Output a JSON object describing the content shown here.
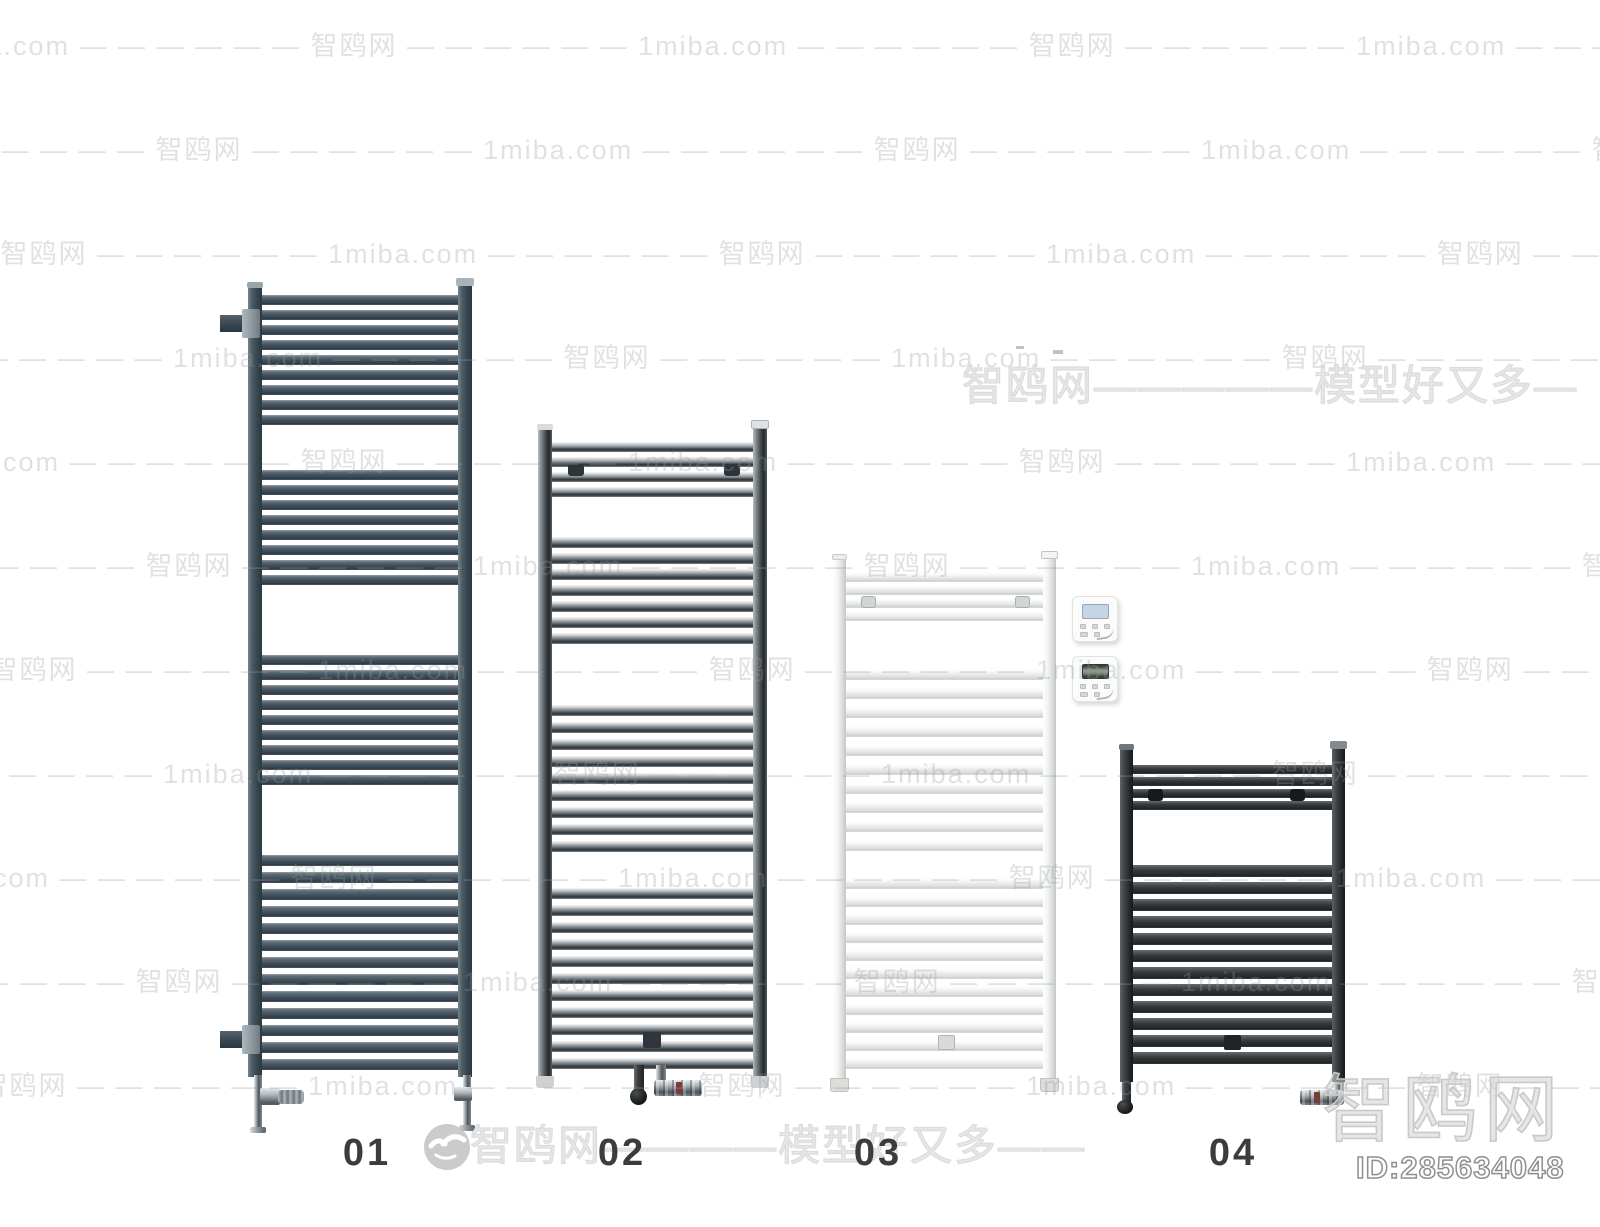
{
  "page": {
    "background_color": "#ffffff"
  },
  "watermarks": {
    "tile_text": "1miba.com — — — — — — 智鸥网 — — — — — — 1miba.com — — — — — — 智鸥网 — — — — — — 1miba.com — — — — — — 智鸥网 — — — — — — 1miba.com — — — — — — 智鸥网 — — — — — —",
    "mid_text": "智鸥网—————模型好又多—",
    "bottom_text": "智鸥网————模型好又多——",
    "corner_text": "智鸥网",
    "id_text": "ID:285634048"
  },
  "products": [
    {
      "label": "01",
      "finish_color": "#43525c"
    },
    {
      "label": "02",
      "finish_color": "#9aa1a6"
    },
    {
      "label": "03",
      "finish_color": "#f2f3f3"
    },
    {
      "label": "04",
      "finish_color": "#34383b"
    }
  ],
  "thermostats": [
    {
      "screen_color": "#c5d5e3"
    },
    {
      "screen_color": "#8ea18c"
    }
  ]
}
